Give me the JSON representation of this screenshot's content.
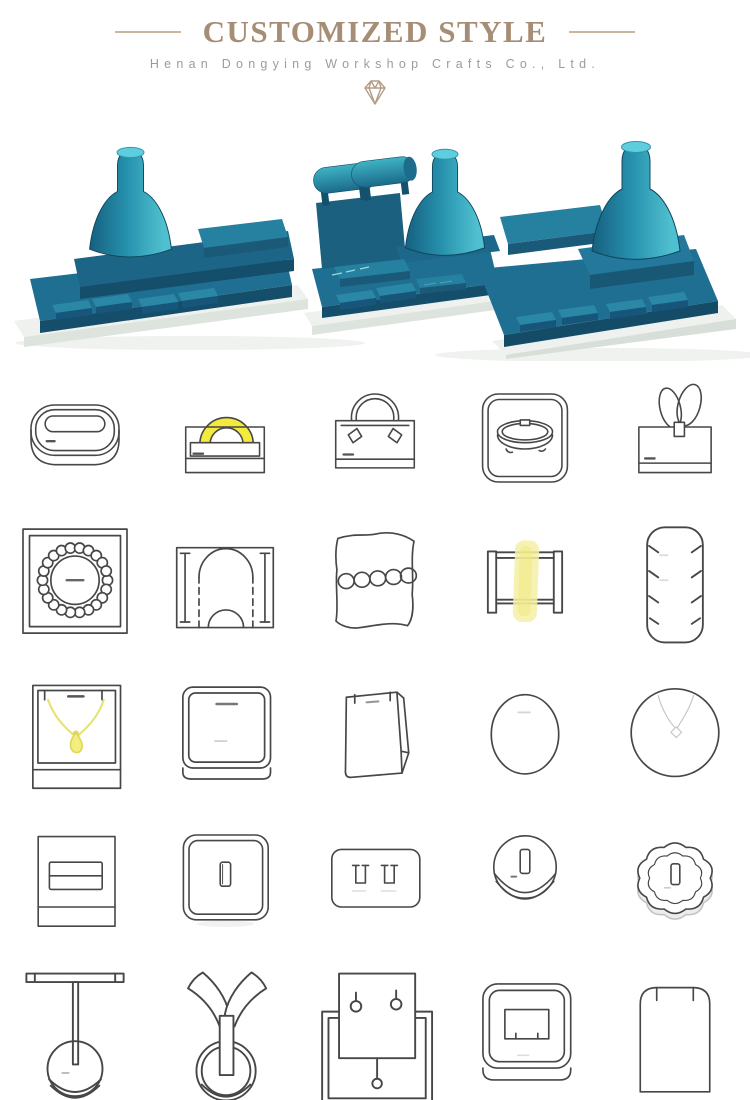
{
  "page": {
    "background": "#ffffff",
    "width": 750,
    "height": 1100
  },
  "header": {
    "title": "CUSTOMIZED STYLE",
    "subtitle": "Henan Dongying Workshop Crafts Co., Ltd.",
    "title_color": "#a68d75",
    "subtitle_color": "#9c9c9c",
    "rule_color": "#c9b7a2",
    "diamond_icon": {
      "name": "diamond-icon",
      "color": "#b49c85"
    }
  },
  "hero": {
    "name": "jewelry-display-set-render",
    "description": "Three teal jewelry display prop sets with necklace busts, bracelet rolls and ring trays on white bases",
    "colors": {
      "teal_dark": "#154e6a",
      "teal": "#1f6f92",
      "teal_mid": "#26809f",
      "teal_light": "#2a87a6",
      "bust_bright": "#4fc0cf",
      "base_white": "#eef1ed",
      "base_edge": "#dde3dd"
    }
  },
  "catalog": {
    "sketch_stroke": "#474747",
    "highlight_yellow": "#f2ea3d",
    "highlight_soft_yellow": "#f5f0a6",
    "rows": [
      {
        "items": [
          "oval-jewelry-case",
          "bangle-arch-stand",
          "bangle-hook-stand",
          "bangle-tray-box",
          "double-loop-ring-stand"
        ]
      },
      {
        "items": [
          "pearl-necklace-tray",
          "arch-dome-easel",
          "bracelet-pillow",
          "watch-band-stand",
          "notched-earring-panel"
        ]
      },
      {
        "items": [
          "pendant-necklace-box",
          "square-display-block",
          "wedge-pouch-display",
          "oval-display-pad",
          "round-necklace-pad"
        ]
      },
      {
        "items": [
          "double-slot-ring-stand",
          "ring-slot-box",
          "double-ring-slot-pad",
          "round-ring-holder",
          "flower-ring-holder"
        ]
      },
      {
        "items": [
          "t-bar-bracelet-stand",
          "y-shape-bracelet-stand",
          "earring-pin-card-stand",
          "earring-clip-box",
          "round-top-earring-card"
        ]
      }
    ],
    "highlighted_items": [
      "bangle-arch-stand",
      "watch-band-stand",
      "pendant-necklace-box"
    ]
  }
}
